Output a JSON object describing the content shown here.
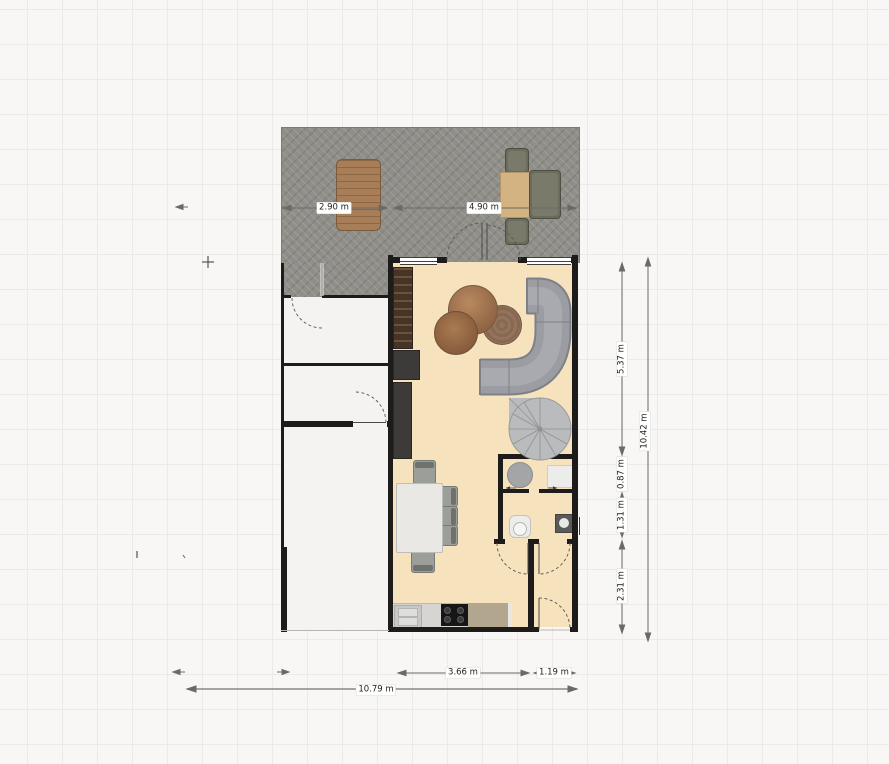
{
  "plan": {
    "type": "floor-plan",
    "unit": "m",
    "dimension_labels": {
      "deck_left_width": "2.90 m",
      "deck_right_width": "4.90 m",
      "right_upper": "5.37 m",
      "right_landing": "0.87 m",
      "right_bath": "1.31 m",
      "right_lower": "2.31 m",
      "right_total": "10.42 m",
      "bottom_kitchen": "3.66 m",
      "bottom_entry": "1.19 m",
      "bottom_total": "10.79 m"
    },
    "rooms": [
      "deck-terrace",
      "living-room",
      "annex-rooms",
      "laundry-room",
      "toilet-room",
      "entry-hall"
    ],
    "furniture": [
      "picnic-table",
      "lounge-chair",
      "lounge-side-table",
      "lounge-sofa",
      "bookshelf",
      "media-cabinet",
      "tall-cabinet",
      "coffee-table-set",
      "sectional-sofa",
      "spiral-staircase",
      "dining-table",
      "dining-chairs",
      "kitchen-counter",
      "kitchen-sink",
      "cooktop",
      "round-washbasin",
      "washing-machine",
      "toilet",
      "hand-basin"
    ]
  },
  "colors": {
    "background": "#f8f7f5",
    "grid_line": "#eceae7",
    "deck": "#8f8e89",
    "wall": "#1d1c1a",
    "living_floor": "#f6e2bd",
    "annex_floor": "#f4f3f1",
    "sofa_gray": "#9b9da3",
    "wood_brown": "#a87e58",
    "counter_gray": "#d7d5d1",
    "dimension_line": "#6b6a64",
    "label_text": "#1e1e1c",
    "label_bg": "#ffffff"
  }
}
